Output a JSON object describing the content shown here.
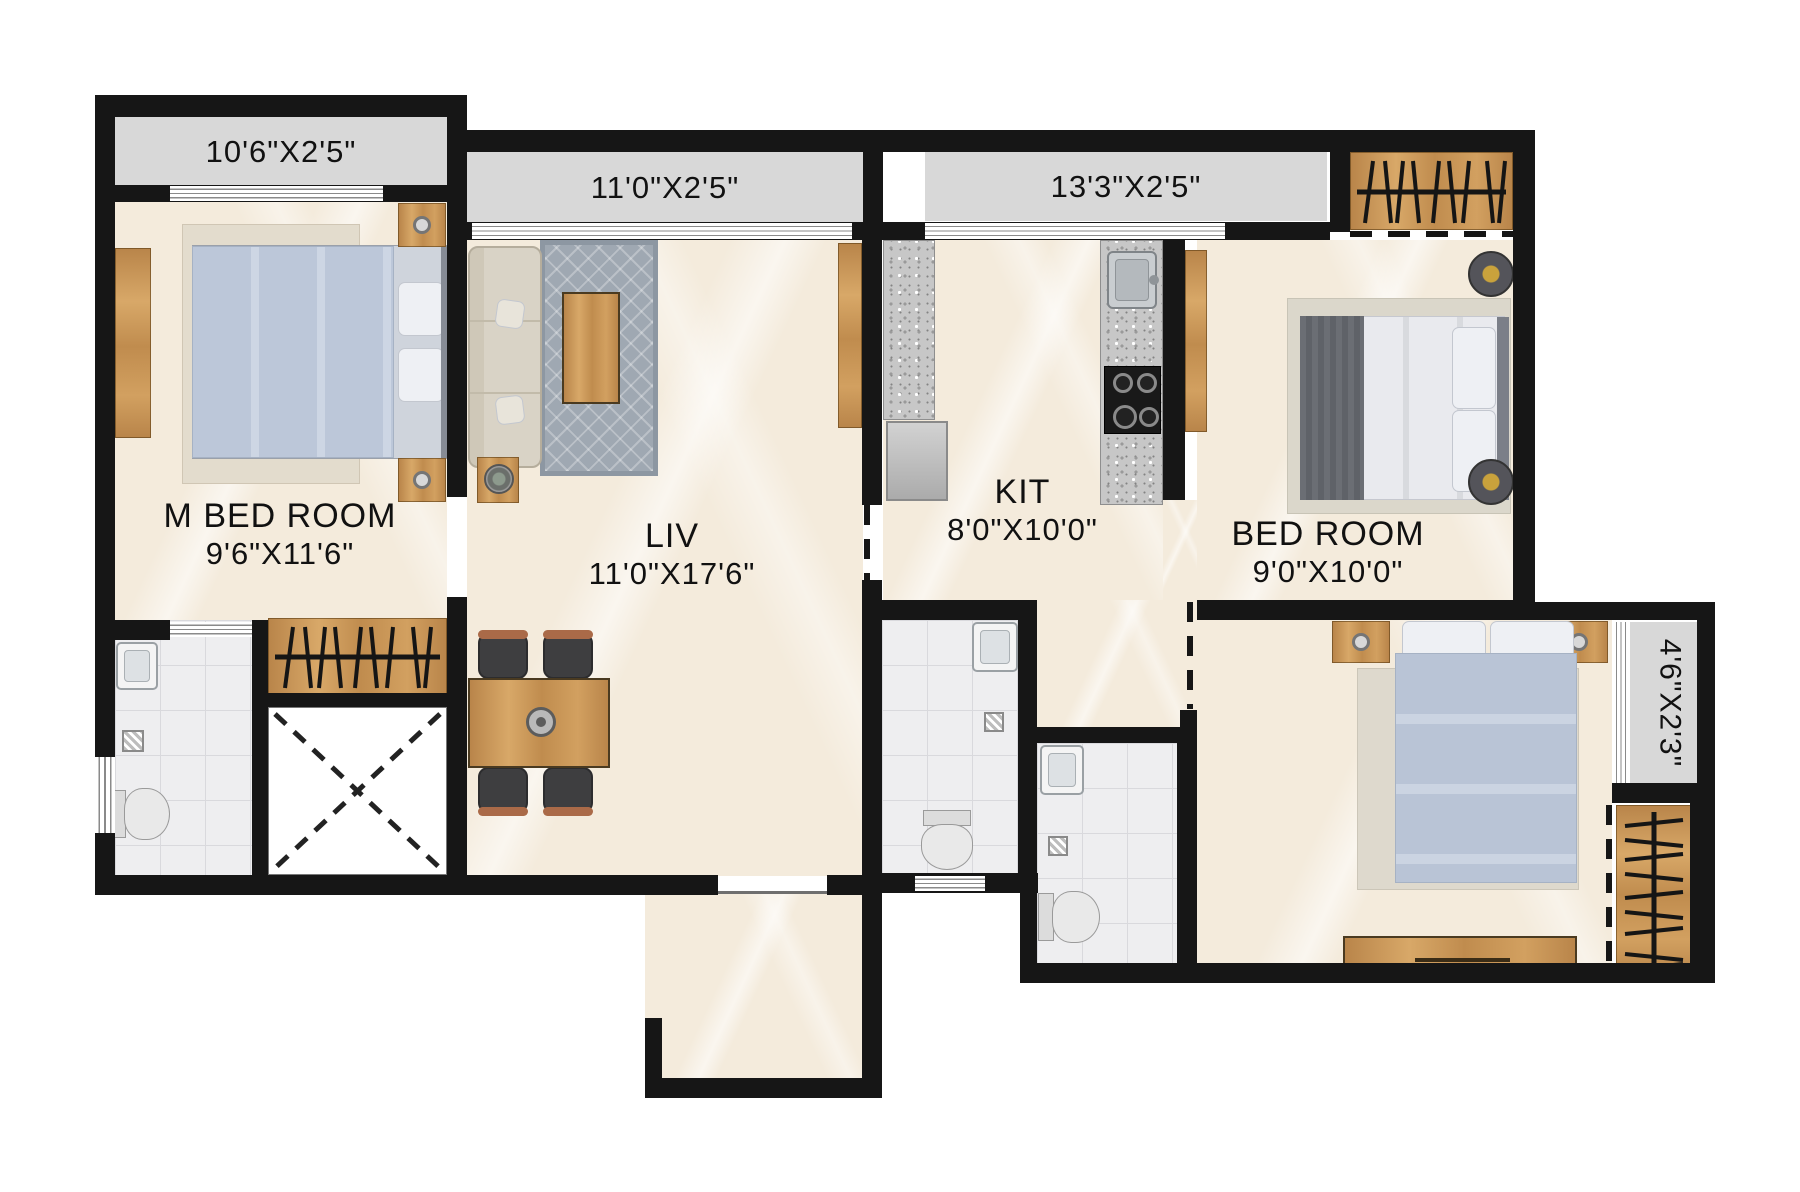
{
  "rooms": [
    {
      "label": "M BED ROOM",
      "dims": "9'6\"X11'6\""
    },
    {
      "label": "LIV",
      "dims": "11'0\"X17'6\""
    },
    {
      "label": "KIT",
      "dims": "8'0\"X10'0\""
    },
    {
      "label": "BED ROOM",
      "dims": "9'0\"X10'0\""
    }
  ],
  "balconies": [
    {
      "dims": "10'6\"X2'5\""
    },
    {
      "dims": "11'0\"X2'5\""
    },
    {
      "dims": "13'3\"X2'5\""
    },
    {
      "dims": "4'6\"X2'3\""
    }
  ],
  "colors": {
    "wall": "#161616",
    "balcony": "#d8d8d8",
    "floor": "#f4ebdc",
    "tile": "#eeeef0",
    "wood": "#c99a5e",
    "granite": "#c7c7c7",
    "duvet": "#bcc7d9",
    "text": "#111111"
  }
}
